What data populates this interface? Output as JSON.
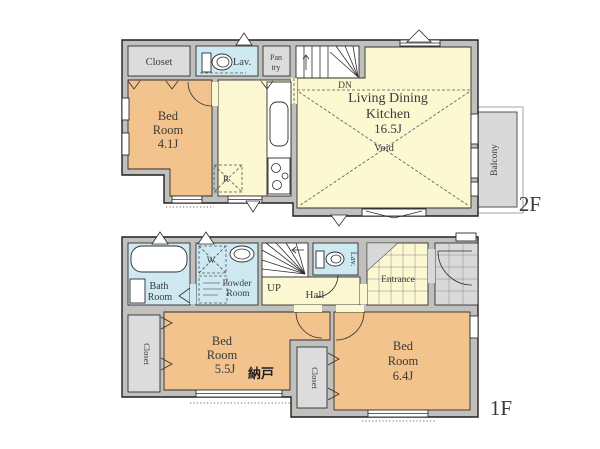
{
  "plan_title": "2-story house floor plan",
  "colors": {
    "tatami_room": "#f2c38d",
    "living_room": "#fbf8d2",
    "wet_room": "#cfe9f2",
    "closet": "#dcdcdc",
    "wall": "#c1c0bd",
    "tile": "#d9d9d9"
  },
  "floor2": {
    "floor_label": "2F",
    "closet": "Closet",
    "lav": "Lav.",
    "pantry_line1": "Pan",
    "pantry_line2": "try",
    "dn": "DN",
    "bedroom_line1": "Bed",
    "bedroom_line2": "Room",
    "bedroom_line3": "4.1J",
    "ldk_line1": "Living Dining",
    "ldk_line2": "Kitchen",
    "ldk_line3": "16.5J",
    "void": "Void",
    "fridge": "R",
    "balcony": "Balcony"
  },
  "floor1": {
    "floor_label": "1F",
    "bath_line1": "Bath",
    "bath_line2": "Room",
    "washer": "W",
    "powder_line1": "Powder",
    "powder_line2": "Room",
    "up": "UP",
    "hall": "Hall",
    "lav": "Lav.",
    "entrance": "Entrance",
    "closet_left": "Closet",
    "closet_mid": "Closet",
    "bedroom55_line1": "Bed",
    "bedroom55_line2": "Room",
    "bedroom55_line3": "5.5J",
    "nando": "納戸",
    "bedroom64_line1": "Bed",
    "bedroom64_line2": "Room",
    "bedroom64_line3": "6.4J"
  }
}
